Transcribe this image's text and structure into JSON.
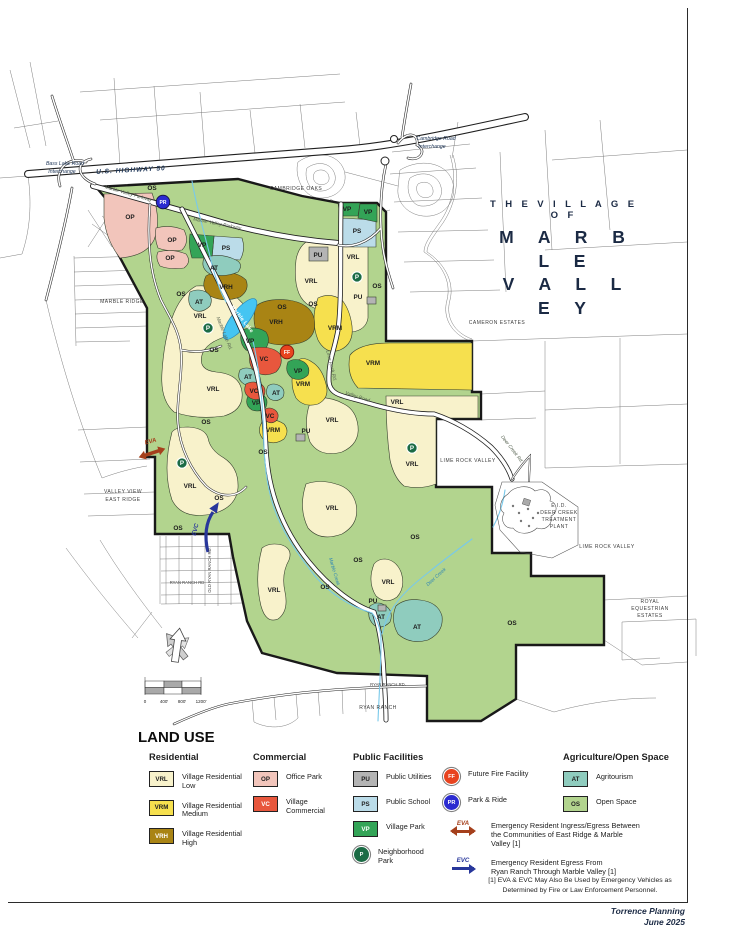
{
  "title": {
    "line1": "T H E   V I L L A G E   O F",
    "line2": "M A R B L E",
    "line3": "V A L L E Y"
  },
  "credit": {
    "line1": "Torrence Planning",
    "line2": "June 2025"
  },
  "colors": {
    "VRL": "#f8f2cb",
    "VRM": "#f6e04e",
    "VRH": "#a98414",
    "OP": "#f2c5bb",
    "VC": "#e8573d",
    "PU": "#b4b4b4",
    "PS": "#bbdce9",
    "VP": "#33a457",
    "AT": "#8fccbe",
    "OS": "#b2d48e",
    "P": "#1b6b45",
    "FF": "#e8431f",
    "PR": "#2b2bd0",
    "EVA": "#a5401c",
    "EVC": "#28379b",
    "lake": "#45c5f2",
    "creek": "#79c9ea",
    "title": "#1b2a44"
  },
  "legend": {
    "heading": "LAND USE",
    "footnote": [
      "[1] EVA & EVC May Also Be Used by Emergency Vehicles as",
      "Determined by Fire or Law Enforcement Personnel."
    ],
    "groups": [
      {
        "name": "Residential",
        "items": [
          {
            "type": "swatch",
            "code": "VRL",
            "label": [
              "Village Residential",
              "Low"
            ]
          },
          {
            "type": "swatch",
            "code": "VRM",
            "label": [
              "Village Residential",
              "Medium"
            ]
          },
          {
            "type": "swatch",
            "code": "VRH",
            "light": true,
            "label": [
              "Village Residential",
              "High"
            ]
          }
        ]
      },
      {
        "name": "Commercial",
        "items": [
          {
            "type": "swatch",
            "code": "OP",
            "label": [
              "Office Park"
            ]
          },
          {
            "type": "swatch",
            "code": "VC",
            "light": true,
            "label": [
              "Village",
              "Commercial"
            ]
          }
        ]
      },
      {
        "name": "Public Facilities",
        "items": [
          {
            "type": "swatch",
            "code": "PU",
            "label": [
              "Public Utilities"
            ]
          },
          {
            "type": "swatch",
            "code": "PS",
            "label": [
              "Public School"
            ]
          },
          {
            "type": "swatch",
            "code": "VP",
            "light": true,
            "label": [
              "Village Park"
            ]
          },
          {
            "type": "circle",
            "code": "P",
            "label": [
              "Neighborhood",
              "Park"
            ]
          }
        ]
      },
      {
        "name": "",
        "items": [
          {
            "type": "circle",
            "code": "FF",
            "label": [
              "Future Fire Facility"
            ]
          },
          {
            "type": "circle",
            "code": "PR",
            "label": [
              "Park & Ride"
            ]
          },
          {
            "type": "arrow-double",
            "code": "EVA",
            "label": [
              "Emergency Resident Ingress/Egress Between",
              "the Communities of East Ridge & Marble Valley [1]"
            ]
          },
          {
            "type": "arrow-right",
            "code": "EVC",
            "label": [
              "Emergency Resident Egress From",
              "Ryan Ranch Through Marble Valley [1]"
            ]
          }
        ]
      },
      {
        "name": "Agriculture/Open Space",
        "items": [
          {
            "type": "swatch",
            "code": "AT",
            "label": [
              "Agritourism"
            ]
          },
          {
            "type": "swatch",
            "code": "OS",
            "label": [
              "Open Space"
            ]
          }
        ]
      }
    ]
  },
  "map": {
    "markers": [
      {
        "k": "PR",
        "x": 163,
        "y": 202
      },
      {
        "k": "FF",
        "x": 287,
        "y": 352
      },
      {
        "k": "P",
        "x": 208,
        "y": 328
      },
      {
        "k": "P",
        "x": 357,
        "y": 277
      },
      {
        "k": "P",
        "x": 182,
        "y": 463
      },
      {
        "k": "P",
        "x": 412,
        "y": 448
      }
    ],
    "labels": [
      {
        "t": "OS",
        "x": 152,
        "y": 190
      },
      {
        "t": "OS",
        "x": 181,
        "y": 296
      },
      {
        "t": "OS",
        "x": 282,
        "y": 309
      },
      {
        "t": "OS",
        "x": 313,
        "y": 306
      },
      {
        "t": "OS",
        "x": 377,
        "y": 288
      },
      {
        "t": "OS",
        "x": 214,
        "y": 352
      },
      {
        "t": "OS",
        "x": 206,
        "y": 424
      },
      {
        "t": "OS",
        "x": 263,
        "y": 454
      },
      {
        "t": "OS",
        "x": 219,
        "y": 500
      },
      {
        "t": "OS",
        "x": 178,
        "y": 530
      },
      {
        "t": "OS",
        "x": 415,
        "y": 539
      },
      {
        "t": "OS",
        "x": 358,
        "y": 562
      },
      {
        "t": "OS",
        "x": 325,
        "y": 589
      },
      {
        "t": "OS",
        "x": 512,
        "y": 625
      },
      {
        "t": "VRL",
        "x": 200,
        "y": 318
      },
      {
        "t": "VRL",
        "x": 311,
        "y": 283
      },
      {
        "t": "VRL",
        "x": 353,
        "y": 259
      },
      {
        "t": "VRL",
        "x": 213,
        "y": 391
      },
      {
        "t": "VRL",
        "x": 332,
        "y": 422
      },
      {
        "t": "VRL",
        "x": 190,
        "y": 488
      },
      {
        "t": "VRL",
        "x": 332,
        "y": 510
      },
      {
        "t": "VRL",
        "x": 397,
        "y": 404
      },
      {
        "t": "VRL",
        "x": 412,
        "y": 466
      },
      {
        "t": "VRL",
        "x": 388,
        "y": 584
      },
      {
        "t": "VRL",
        "x": 274,
        "y": 592
      },
      {
        "t": "VRM",
        "x": 335,
        "y": 330
      },
      {
        "t": "VRM",
        "x": 303,
        "y": 386
      },
      {
        "t": "VRM",
        "x": 373,
        "y": 365
      },
      {
        "t": "VRM",
        "x": 273,
        "y": 432
      },
      {
        "t": "VRH",
        "x": 226,
        "y": 289
      },
      {
        "t": "VRH",
        "x": 276,
        "y": 324
      },
      {
        "t": "OP",
        "x": 130,
        "y": 219
      },
      {
        "t": "OP",
        "x": 172,
        "y": 242
      },
      {
        "t": "OP",
        "x": 170,
        "y": 260
      },
      {
        "t": "VC",
        "x": 264,
        "y": 361
      },
      {
        "t": "VC",
        "x": 254,
        "y": 393
      },
      {
        "t": "VC",
        "x": 270,
        "y": 418
      },
      {
        "t": "VP",
        "x": 347,
        "y": 211
      },
      {
        "t": "VP",
        "x": 368,
        "y": 214
      },
      {
        "t": "VP",
        "x": 202,
        "y": 247
      },
      {
        "t": "VP",
        "x": 250,
        "y": 343
      },
      {
        "t": "VP",
        "x": 298,
        "y": 373
      },
      {
        "t": "VP",
        "x": 256,
        "y": 405
      },
      {
        "t": "PS",
        "x": 226,
        "y": 250
      },
      {
        "t": "PS",
        "x": 357,
        "y": 233
      },
      {
        "t": "PU",
        "x": 318,
        "y": 257
      },
      {
        "t": "PU",
        "x": 358,
        "y": 299
      },
      {
        "t": "PU",
        "x": 306,
        "y": 433
      },
      {
        "t": "PU",
        "x": 373,
        "y": 603
      },
      {
        "t": "AT",
        "x": 214,
        "y": 270
      },
      {
        "t": "AT",
        "x": 199,
        "y": 304
      },
      {
        "t": "AT",
        "x": 248,
        "y": 379
      },
      {
        "t": "AT",
        "x": 276,
        "y": 395
      },
      {
        "t": "AT",
        "x": 381,
        "y": 619
      },
      {
        "t": "AT",
        "x": 417,
        "y": 629
      },
      {
        "t": "MARBLE RIDGE",
        "x": 122,
        "y": 303,
        "c": "place"
      },
      {
        "t": "CAMBRIDGE OAKS",
        "x": 296,
        "y": 190,
        "c": "place"
      },
      {
        "t": "CAMERON ESTATES",
        "x": 497,
        "y": 324,
        "c": "place"
      },
      {
        "t": "LIME ROCK VALLEY",
        "x": 468,
        "y": 462,
        "c": "place"
      },
      {
        "t": "LIME ROCK VALLEY",
        "x": 607,
        "y": 548,
        "c": "place"
      },
      {
        "t": "VALLEY VIEW",
        "x": 123,
        "y": 493,
        "c": "place"
      },
      {
        "t": "EAST RIDGE",
        "x": 123,
        "y": 501,
        "c": "place"
      },
      {
        "t": "E.I.D.",
        "x": 559,
        "y": 507,
        "c": "place"
      },
      {
        "t": "DEER CREEK",
        "x": 559,
        "y": 514,
        "c": "place"
      },
      {
        "t": "TREATMENT",
        "x": 559,
        "y": 521,
        "c": "place"
      },
      {
        "t": "PLANT",
        "x": 559,
        "y": 528,
        "c": "place"
      },
      {
        "t": "ROYAL",
        "x": 650,
        "y": 603,
        "c": "place"
      },
      {
        "t": "EQUESTRIAN",
        "x": 650,
        "y": 610,
        "c": "place"
      },
      {
        "t": "ESTATES",
        "x": 650,
        "y": 617,
        "c": "place"
      },
      {
        "t": "RYAN RANCH",
        "x": 378,
        "y": 709,
        "c": "place"
      },
      {
        "t": "RYAN RANCH RD",
        "x": 187,
        "y": 584,
        "c": "tiny"
      },
      {
        "t": "OLD RYAN RANCH RD.",
        "x": 211,
        "y": 570,
        "c": "tiny",
        "r": -90
      },
      {
        "t": "RYAN RANCH RD.",
        "x": 388,
        "y": 686,
        "c": "tiny"
      },
      {
        "t": "Bass Lake Road",
        "x": 65,
        "y": 165,
        "c": "note"
      },
      {
        "t": "Interchange",
        "x": 62,
        "y": 173,
        "c": "note"
      },
      {
        "t": "Cambridge Road",
        "x": 436,
        "y": 140,
        "c": "note"
      },
      {
        "t": "Interchange",
        "x": 432,
        "y": 148,
        "c": "note"
      },
      {
        "t": "U.S. HIGHWAY 50",
        "x": 131,
        "y": 172,
        "c": "hwy",
        "r": -3
      },
      {
        "t": "Marble Valley Parkway",
        "x": 128,
        "y": 195,
        "c": "road",
        "r": 16
      },
      {
        "t": "Marble Valley Parkway",
        "x": 217,
        "y": 225,
        "c": "road",
        "r": 11
      },
      {
        "t": "Marble Lake Rd.",
        "x": 223,
        "y": 334,
        "c": "road",
        "r": 68
      },
      {
        "t": "Lime Rock Rd.",
        "x": 330,
        "y": 366,
        "c": "road",
        "r": 76
      },
      {
        "t": "Valley Road",
        "x": 357,
        "y": 398,
        "c": "road",
        "r": 18
      },
      {
        "t": "Deer Creek Rd.",
        "x": 511,
        "y": 450,
        "c": "road",
        "r": 52
      },
      {
        "t": "Marble Creek",
        "x": 333,
        "y": 572,
        "c": "water",
        "r": 74
      },
      {
        "t": "Deer Creek",
        "x": 437,
        "y": 578,
        "c": "water",
        "r": -42
      },
      {
        "t": "Marble Lake",
        "x": 241,
        "y": 320,
        "c": "lake",
        "r": 52
      },
      {
        "t": "EVA",
        "x": 151,
        "y": 443,
        "c": "eva",
        "r": -15
      },
      {
        "t": "EVC",
        "x": 197,
        "y": 530,
        "c": "evc",
        "r": -75
      },
      {
        "t": "0",
        "x": 145,
        "y": 703,
        "c": "scale"
      },
      {
        "t": "400'",
        "x": 164,
        "y": 703,
        "c": "scale"
      },
      {
        "t": "800'",
        "x": 182,
        "y": 703,
        "c": "scale"
      },
      {
        "t": "1200'",
        "x": 201,
        "y": 703,
        "c": "scale"
      }
    ]
  }
}
